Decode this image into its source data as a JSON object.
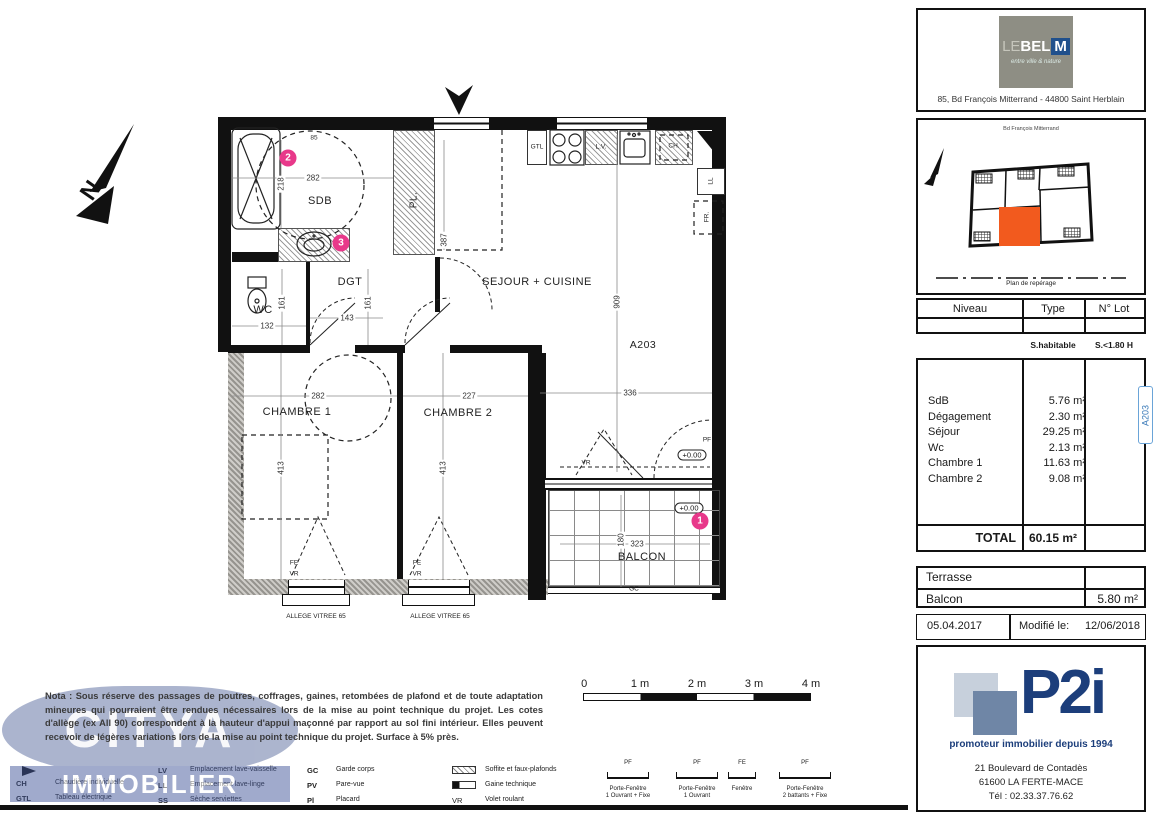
{
  "plan": {
    "north_label": "N",
    "rooms": {
      "sdb": "SDB",
      "wc": "WC",
      "dgt": "DGT",
      "sejour": "SEJOUR + CUISINE",
      "ch1": "CHAMBRE 1",
      "ch2": "CHAMBRE 2",
      "balcon": "BALCON"
    },
    "unit": "A203",
    "fixtures": {
      "gtl": "GTL",
      "lv": "L.V.",
      "ch": "CH.",
      "ll": "LL",
      "fr": "FR.",
      "pl": "PL."
    },
    "openings": {
      "pf": "PF",
      "fe": "FE",
      "vr": "VR",
      "gc": "GC"
    },
    "level_marker": "+0.00",
    "circled": {
      "one": "1",
      "two": "2",
      "three": "3"
    },
    "allege_note": "ALLEGE VITREE 65",
    "dims": {
      "sdb_top": "85",
      "sdb_w": "282",
      "sdb_h": "218",
      "pl_d": "387",
      "wc_h": "161",
      "dgt_h": "161",
      "dgt_w": "143",
      "wc_w": "132",
      "sejour_l": "909",
      "sejour_w": "336",
      "ch1_w": "282",
      "ch2_w": "227",
      "ch1_h": "413",
      "ch2_h": "413",
      "balcon_w": "323",
      "balcon_d": "180"
    }
  },
  "scalebar": {
    "t0": "0",
    "t1": "1 m",
    "t2": "2 m",
    "t3": "3 m",
    "t4": "4 m"
  },
  "nota": "Nota : Sous réserve des passages de poutres, coffrages, gaines, retombées de plafond et de toute adaptation mineures qui pourraient être rendues nécessaires lors de la mise au point technique du projet. Les cotes d'allège (ex All 90) correspondent à la hauteur d'appui maçonné par rapport au sol fini intérieur. Elles peuvent recevoir de légères variations lors de la mise au point technique du projet. Surface à 5% près.",
  "watermark": {
    "line1": "CITYA",
    "line2": "IMMOBILIER"
  },
  "legend": {
    "col1": [
      {
        "abbr": "CH",
        "label": "Chaudière individuelle"
      },
      {
        "abbr": "GTL",
        "label": "Tableau électrique"
      }
    ],
    "col2": [
      {
        "abbr": "LV",
        "label": "Emplacement lave-vaisselle"
      },
      {
        "abbr": "LL",
        "label": "Emplacement lave-linge"
      },
      {
        "abbr": "SS",
        "label": "Sèche serviettes"
      }
    ],
    "col3": [
      {
        "abbr": "GC",
        "label": "Garde corps"
      },
      {
        "abbr": "PV",
        "label": "Pare-vue"
      },
      {
        "abbr": "Pl",
        "label": "Placard"
      }
    ],
    "col4": [
      {
        "label": "Soffite et faux-plafonds"
      },
      {
        "label": "Gaine technique"
      },
      {
        "abbr": "VR",
        "label": "Volet roulant"
      }
    ],
    "windows": [
      {
        "abbr": "PF",
        "name": "Porte-Fenêtre",
        "detail": "1 Ouvrant + Fixe"
      },
      {
        "abbr": "PF",
        "name": "Porte-Fenêtre",
        "detail": "1 Ouvrant"
      },
      {
        "abbr": "FE",
        "name": "Fenêtre",
        "detail": ""
      },
      {
        "abbr": "PF",
        "name": "Porte-Fenêtre",
        "detail": "2 battants + Fixe"
      }
    ]
  },
  "sidebar": {
    "brand": {
      "le": "LE",
      "bel": "BEL",
      "m": "M",
      "tagline": "entre ville & nature",
      "address": "85, Bd François Mitterrand - 44800 Saint Herblain"
    },
    "siteplan": {
      "street": "Bd François Mitterrand",
      "caption": "Plan de repérage"
    },
    "lot": {
      "niveau": "Niveau",
      "type": "Type",
      "nlot": "N° Lot"
    },
    "sheaders": {
      "habitable": "S.habitable",
      "low": "S.<1.80 H"
    },
    "surfaces": {
      "rows": [
        {
          "name": "SdB",
          "value": "5.76 m²"
        },
        {
          "name": "Dégagement",
          "value": "2.30 m²"
        },
        {
          "name": "Séjour",
          "value": "29.25 m²"
        },
        {
          "name": "Wc",
          "value": "2.13 m²"
        },
        {
          "name": "Chambre 1",
          "value": "11.63 m²"
        },
        {
          "name": "Chambre 2",
          "value": "9.08 m²"
        }
      ],
      "total_label": "TOTAL",
      "total_value": "60.15 m²",
      "tab": "A203"
    },
    "exterior": {
      "rows": [
        {
          "name": "Terrasse",
          "value": ""
        },
        {
          "name": "Balcon",
          "value": "5.80 m²"
        }
      ]
    },
    "dates": {
      "created": "05.04.2017",
      "modified_label": "Modifié le:",
      "modified": "12/06/2018"
    },
    "p2i": {
      "name": "P2i",
      "tagline": "promoteur immobilier depuis 1994",
      "address1": "21 Boulevard de Contadès",
      "address2": "61600 LA FERTE-MACE",
      "phone": "Tél : 02.33.37.76.62"
    }
  },
  "colors": {
    "accent_pink": "#e8388a",
    "unit_orange": "#f25a1e",
    "brand_blue": "#1c3e7b",
    "tab_blue": "#3a7ab8"
  }
}
